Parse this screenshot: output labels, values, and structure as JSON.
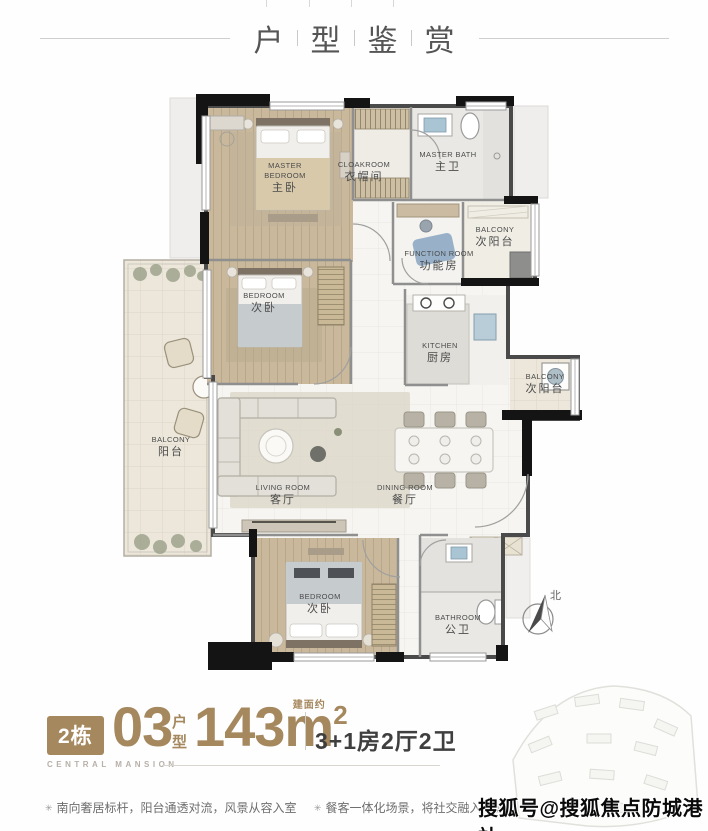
{
  "header": {
    "chars": [
      "户",
      "型",
      "鉴",
      "赏"
    ]
  },
  "plan": {
    "rooms": [
      {
        "id": "master-bedroom",
        "en": "MASTER BEDROOM",
        "cn": "主卧"
      },
      {
        "id": "cloakroom",
        "en": "CLOAKROOM",
        "cn": "衣帽间"
      },
      {
        "id": "master-bath",
        "en": "MASTER BATH",
        "cn": "主卫"
      },
      {
        "id": "balcony-top-right",
        "en": "BALCONY",
        "cn": "次阳台"
      },
      {
        "id": "function-room",
        "en": "FUNCTION ROOM",
        "cn": "功能房"
      },
      {
        "id": "bedroom-middle",
        "en": "BEDROOM",
        "cn": "次卧"
      },
      {
        "id": "kitchen",
        "en": "KITCHEN",
        "cn": "厨房"
      },
      {
        "id": "balcony-right",
        "en": "BALCONY",
        "cn": "次阳台"
      },
      {
        "id": "balcony-left",
        "en": "BALCONY",
        "cn": "阳台"
      },
      {
        "id": "living-room",
        "en": "LIVING ROOM",
        "cn": "客厅"
      },
      {
        "id": "dining-room",
        "en": "DINING ROOM",
        "cn": "餐厅"
      },
      {
        "id": "bedroom-bottom",
        "en": "BEDROOM",
        "cn": "次卧"
      },
      {
        "id": "bathroom",
        "en": "BATHROOM",
        "cn": "公卫"
      }
    ],
    "compass_label": "北"
  },
  "info": {
    "building_badge": "2栋",
    "unit_number": "03",
    "unit_label_top": "户",
    "unit_label_bottom": "型",
    "area_prefix": "建面约",
    "area_value": "143m",
    "area_sup": "2",
    "layout_text": "3+1房2厅2卫",
    "brand": "CENTRAL MANSION"
  },
  "notes": {
    "marker": "✳",
    "items": [
      "南向奢居标杆，阳台通透对流，风景从容入室",
      "餐客一体化场景，将社交融入家庭日常生活"
    ]
  },
  "watermark": {
    "text": "搜狐号@搜狐焦点防城港站"
  },
  "colors": {
    "accent_brown": "#a6885e",
    "wall_black": "#141414",
    "text_dark": "#3f3f3f"
  }
}
